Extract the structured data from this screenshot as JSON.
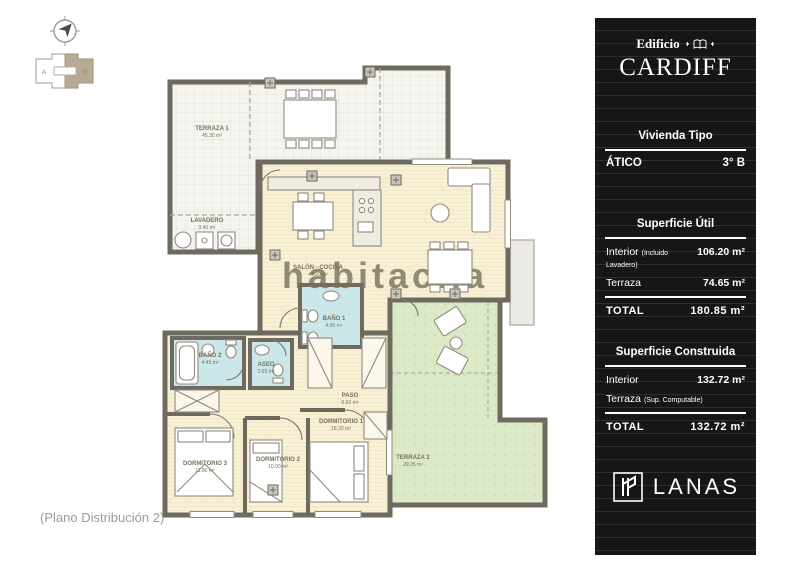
{
  "page": {
    "caption": "(Plano Distribución 2)"
  },
  "keyplan": {
    "section_a": "A",
    "section_b": "B"
  },
  "floorplan": {
    "watermark": "habitaclia",
    "rooms": [
      {
        "name": "TERRAZA 1",
        "area": "45.30 m²"
      },
      {
        "name": "LAVADERO",
        "area": "3.40 m²"
      },
      {
        "name": "SALÓN - COCINA",
        "area": "44.20 m²"
      },
      {
        "name": "BAÑO 1",
        "area": "4.90 m²"
      },
      {
        "name": "BAÑO 2",
        "area": "4.45 m²"
      },
      {
        "name": "ASEO",
        "area": "2.65 m²"
      },
      {
        "name": "PASO",
        "area": "6.60 m²"
      },
      {
        "name": "DORMITORIO 1",
        "area": "18.20 m²"
      },
      {
        "name": "DORMITORIO 2",
        "area": "10.00 m²"
      },
      {
        "name": "DORMITORIO 3",
        "area": "11.80 m²"
      },
      {
        "name": "TERRAZA 2",
        "area": "29.35 m²"
      }
    ]
  },
  "panel": {
    "building_label": "Edificio",
    "building_name": "CARDIFF",
    "vivienda_tipo_label": "Vivienda Tipo",
    "tipo": {
      "left": "ÁTICO",
      "right": "3° B"
    },
    "superficie_util": {
      "title": "Superficie Útil",
      "rows": [
        {
          "label": "Interior",
          "note": "(Incluido Lavadero)",
          "value": "106.20 m²"
        },
        {
          "label": "Terraza",
          "note": "",
          "value": "74.65 m²"
        }
      ],
      "total_label": "TOTAL",
      "total_value": "180.85 m²"
    },
    "superficie_construida": {
      "title": "Superficie Construida",
      "rows": [
        {
          "label": "Interior",
          "note": "",
          "value": "132.72 m²"
        },
        {
          "label": "Terraza",
          "note": "(Sup. Computable)",
          "value": ""
        }
      ],
      "total_label": "TOTAL",
      "total_value": "132.72 m²"
    },
    "brand": "LANAS"
  },
  "colors": {
    "panel_bg": "#161616",
    "wall": "#6f6a60",
    "floor_interior": "#f8f1d7",
    "floor_bath": "#cde8ea",
    "floor_terrace2": "#dce9c6",
    "keyplan_highlight": "#b6aa94"
  }
}
